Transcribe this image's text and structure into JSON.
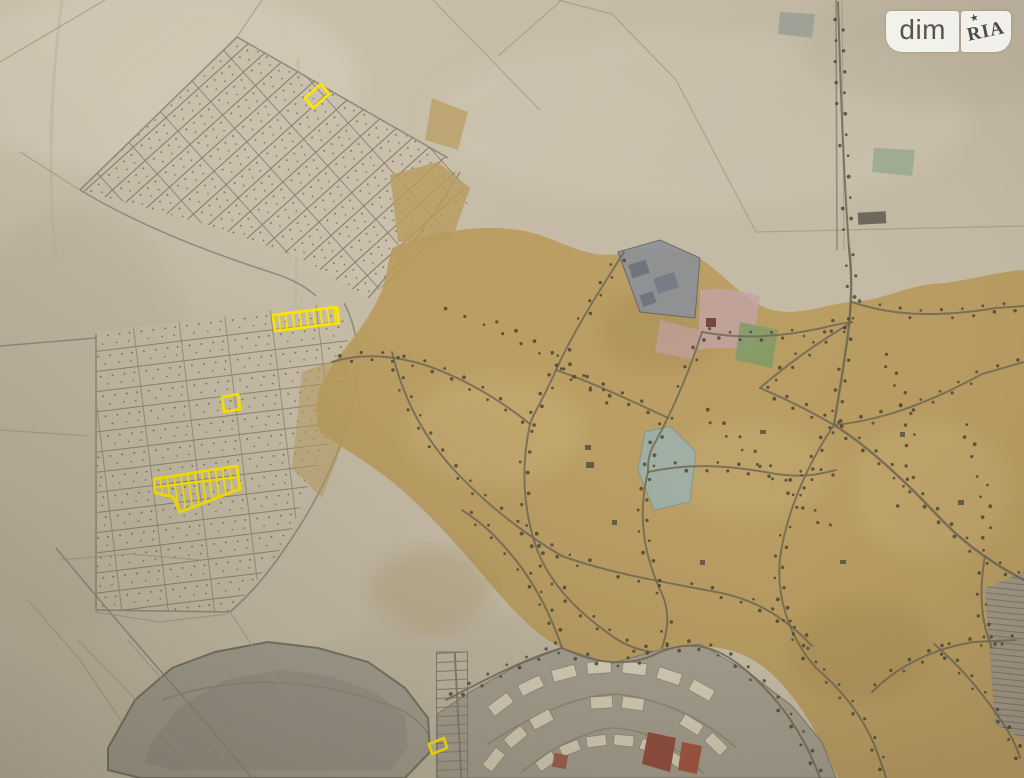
{
  "watermark": {
    "left": "dim",
    "right": "RIA",
    "star": "★"
  },
  "map": {
    "description": "Photograph of a paper general plan (cadastral map) with land plots for sale outlined in yellow",
    "highlight_color": "#ffe600",
    "highlighted_plots": [
      {
        "id": "north-grid-plot",
        "points": "329,94 321,84 305,98 313,108",
        "hatched": false
      },
      {
        "id": "west-strip-plot",
        "points": "339,323 337,307 273,315 275,331",
        "hatched": true
      },
      {
        "id": "west-small-plot",
        "points": "240,409 238,394 222,397 224,412",
        "hatched": false
      },
      {
        "id": "west-large-plot",
        "points": "154,479 237,466 240,489 180,512 173,497 155,493",
        "hatched": true,
        "extra_lines": [
          [
            156,
            487,
            238,
            477
          ]
        ]
      },
      {
        "id": "south-plot",
        "points": "447,748 444,738 429,744 432,754",
        "hatched": false
      }
    ]
  },
  "colors": {
    "paper": "#c8bfaa",
    "paperLight": "#d6cebb",
    "paperDark": "#b3a995",
    "tan": "#b89a5c",
    "tanLight": "#cdb67e",
    "tanDark": "#9c8148",
    "road": "#6e6753",
    "dot": "#453e2c",
    "lake": "#a19b8f",
    "lakeEdge": "#75705f",
    "plan": "#a49d8f",
    "building": "#d6cdb8",
    "industrial": "#8b9098",
    "pink": "#c3a4a6",
    "green": "#7e9b66",
    "pond": "#9db1ac",
    "red": "#8f4b3b",
    "highlight": "#ffe600"
  }
}
